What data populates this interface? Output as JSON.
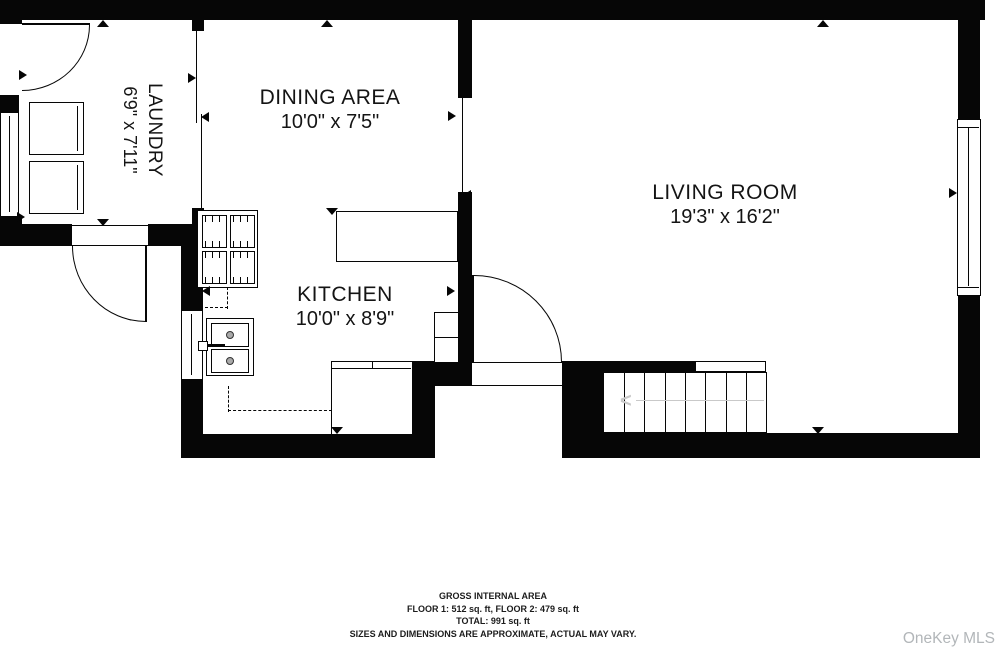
{
  "rooms": {
    "laundry": {
      "name": "LAUNDRY",
      "dims": "6'9\" x 7'11\""
    },
    "dining": {
      "name": "DINING AREA",
      "dims": "10'0\" x 7'5\""
    },
    "kitchen": {
      "name": "KITCHEN",
      "dims": "10'0\" x 8'9\""
    },
    "living": {
      "name": "LIVING ROOM",
      "dims": "19'3\" x 16'2\""
    }
  },
  "stairs": {
    "direction_arrow": "<"
  },
  "footer": {
    "line1": "GROSS INTERNAL AREA",
    "line2": "FLOOR 1: 512 sq. ft, FLOOR 2: 479 sq. ft",
    "line3": "TOTAL: 991 sq. ft",
    "line4": "SIZES AND DIMENSIONS ARE APPROXIMATE, ACTUAL MAY VARY."
  },
  "watermark": "OneKey MLS",
  "colors": {
    "wall": "#060606",
    "stair_arrow": "#c9c9c9",
    "watermark_text": "#b2b6b9"
  }
}
